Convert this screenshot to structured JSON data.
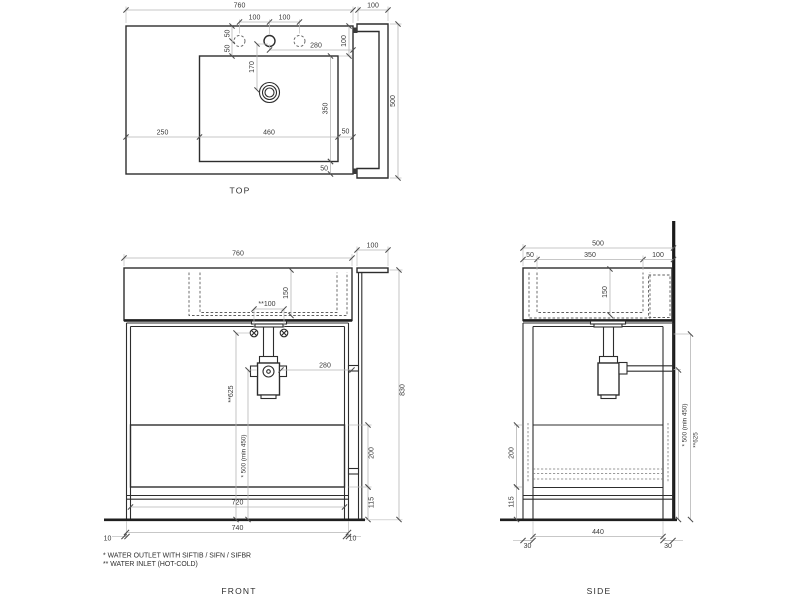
{
  "drawing": {
    "type": "technical-drawing",
    "palette": {
      "object_line": "#2d2d2d",
      "dimension_line": "#b5b5b5",
      "hidden_line": "#5f5f5f",
      "text": "#3a3a3a",
      "background": "#ffffff"
    }
  },
  "views": {
    "top": {
      "title": "TOP",
      "dims": {
        "overall_width": "760",
        "panel_width": "100",
        "hole_spacing_a": "100",
        "hole_spacing_b": "100",
        "edge_to_hole": "50",
        "hole_to_basin": "50",
        "back_gap": "100",
        "hole_to_edge": "280",
        "hole_to_drain": "170",
        "basin_depth": "350",
        "basin_front_gap": "50",
        "left_offset": "250",
        "basin_width": "460",
        "right_gap": "50",
        "panel_depth": "500"
      }
    },
    "front": {
      "title": "FRONT",
      "dims": {
        "overall_width": "760",
        "panel_width": "100",
        "basin_height": "150",
        "inlet_spacing": "**100",
        "trap_offset": "280",
        "inlet_height": "**625",
        "outlet_height": "* 500 (min 450)",
        "drawer_height": "200",
        "base_height": "115",
        "overall_height": "830",
        "drawer_width": "720",
        "leg_span": "740",
        "overhang_left": "10",
        "overhang_right": "10"
      }
    },
    "side": {
      "title": "SIDE",
      "dims": {
        "overall_depth": "500",
        "front_gap": "50",
        "basin_depth": "350",
        "back_gap": "100",
        "basin_height": "150",
        "drawer_height": "200",
        "base_height": "115",
        "inner_span": "440",
        "leg_front": "30",
        "leg_back": "30",
        "outlet_height": "* 500 (min 450)",
        "inlet_height": "**625"
      }
    }
  },
  "footnotes": {
    "outlet": "*  WATER OUTLET WITH SIFTIB / SIFN / SIFBR",
    "inlet": "** WATER INLET (HOT-COLD)"
  }
}
